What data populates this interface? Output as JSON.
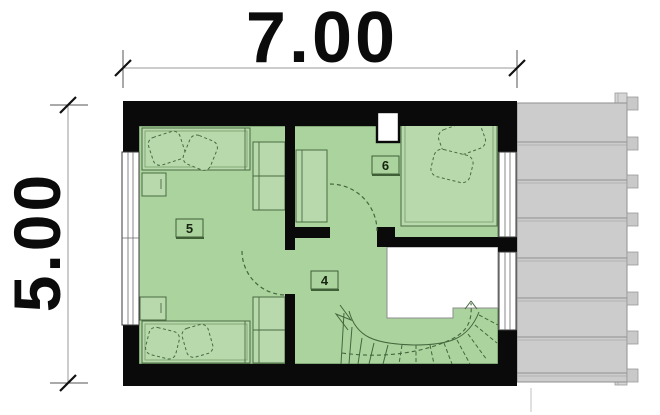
{
  "dimensions": {
    "width_m": "7.00",
    "height_m": "5.00"
  },
  "rooms": [
    {
      "number": "5"
    },
    {
      "number": "6"
    },
    {
      "number": "4"
    }
  ],
  "colors": {
    "wall": "#0a0a0a",
    "room_fill": "#abd39e",
    "furniture_fill": "#b7d9ab",
    "furniture_line": "#4a6b42",
    "roof_fill": "#cccccc",
    "roof_line": "#8f8f8f",
    "window_frame": "#3a3a3a",
    "dimension_line": "#9a9a9a",
    "text": "#0b0b0b",
    "background": "#ffffff"
  }
}
